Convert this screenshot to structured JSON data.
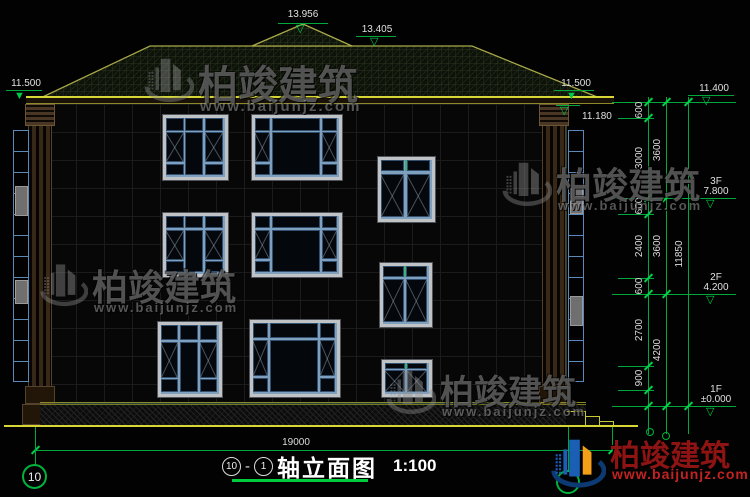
{
  "drawing": {
    "title": {
      "axis_from": "10",
      "dash": "-",
      "axis_to": "1",
      "text": "轴立面图",
      "scale": "1:100"
    },
    "axis_bubble_left": "10",
    "overall_width": "19000"
  },
  "dims": {
    "top_peak": "13.956",
    "top_ridge": "13.405",
    "eave_left": "11.500",
    "eave_right": "11.500",
    "eave_soffit": "11.180",
    "right_top": "11.400",
    "chain_inner": [
      "600",
      "3000",
      "600",
      "2400",
      "600",
      "2700",
      "900"
    ],
    "chain_floors": [
      "3600",
      "3600",
      "4200"
    ],
    "chain_total": "11850",
    "levels": [
      {
        "floor": "3F",
        "value": "7.800"
      },
      {
        "floor": "2F",
        "value": "4.200"
      },
      {
        "floor": "1F",
        "value": "±0.000"
      }
    ]
  },
  "watermark": {
    "brand": "柏竣建筑",
    "site": "www.baijunjz.com"
  },
  "logo": {
    "brand": "柏竣建筑",
    "site": "www.baijunjz.com"
  },
  "colors": {
    "dim_green": "#00b33c",
    "ground_yellow": "#d6d636",
    "window_blue": "#5b8ab8",
    "roof_olive": "#a8a848",
    "logo_red": "#8e1313",
    "logo_site_red": "#c22222"
  }
}
